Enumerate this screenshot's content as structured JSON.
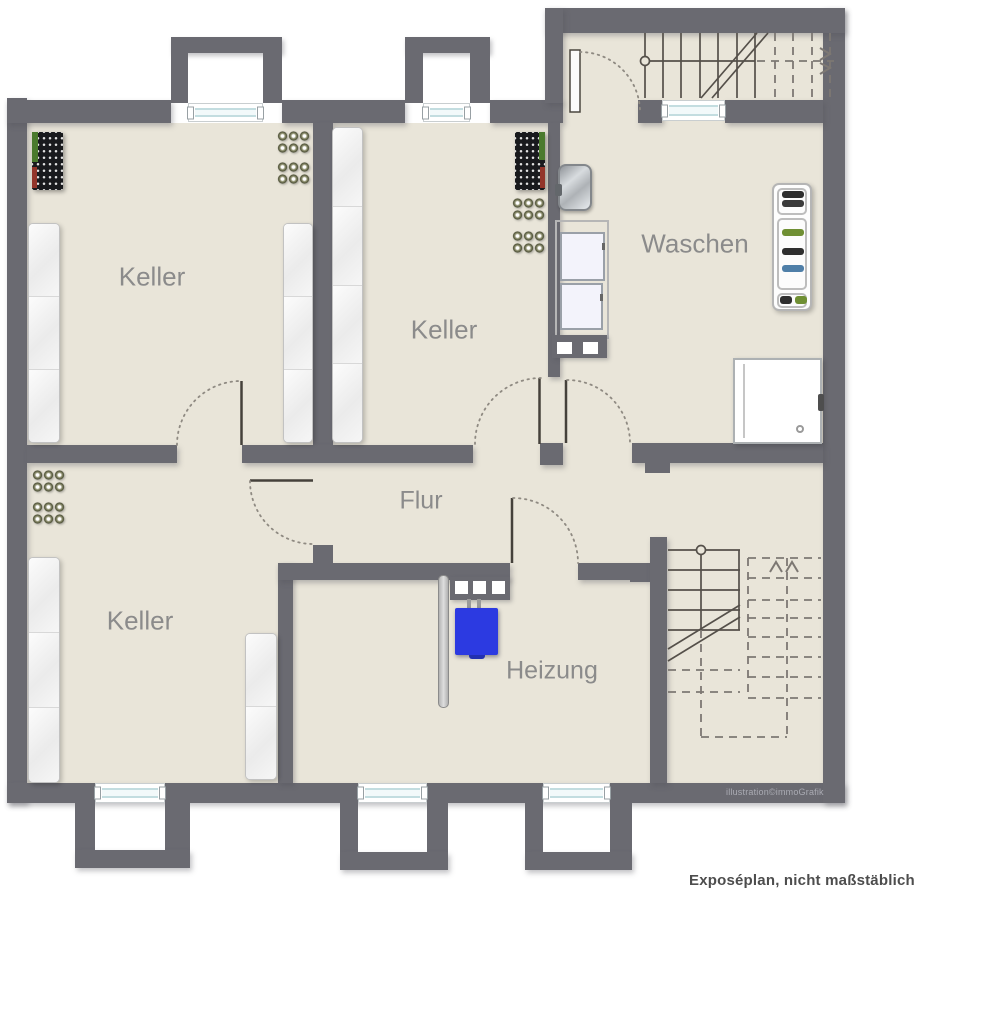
{
  "meta": {
    "type": "basement floor plan",
    "watermark": "illustration©immoGrafik",
    "caption": "Exposéplan, nicht maßstäblich"
  },
  "rooms": [
    {
      "id": "keller-top-left",
      "label": "Keller"
    },
    {
      "id": "keller-middle",
      "label": "Keller"
    },
    {
      "id": "waschen",
      "label": "Waschen"
    },
    {
      "id": "flur",
      "label": "Flur"
    },
    {
      "id": "keller-bottom-left",
      "label": "Keller"
    },
    {
      "id": "heizung",
      "label": "Heizung"
    }
  ],
  "palette": {
    "wall": "#6a6a71",
    "floor": "#e9e5d9",
    "background": "#ffffff",
    "room_label": "#8b8b8b",
    "boiler_blue": "#2c3ae1",
    "rack_green": "#4a7a2d",
    "rack_red": "#93352a",
    "window_glass": "#c3dde0",
    "stair_solid": "#55504a",
    "stair_dashed": "#7d7873"
  },
  "furniture": [
    "wine-rack (2×, dark with bottle grid)",
    "bottle-groups (6 clusters of 3×2 bottles)",
    "storage-shelves (5 white units)",
    "sink (Waschen)",
    "washing-machines (2, Waschen)",
    "laundry-block (wall block with two basins)",
    "shoe-rack (Waschen, with shoes)",
    "shower (Waschen)",
    "boiler (blue, Heizung)",
    "chimney-block (3 flues, Heizung)",
    "flue-pipe (Heizung)",
    "staircase-upper (top right)",
    "staircase-lower (bottom right)",
    "windows (6 with light wells)",
    "door-swings (6 dotted arcs)"
  ]
}
